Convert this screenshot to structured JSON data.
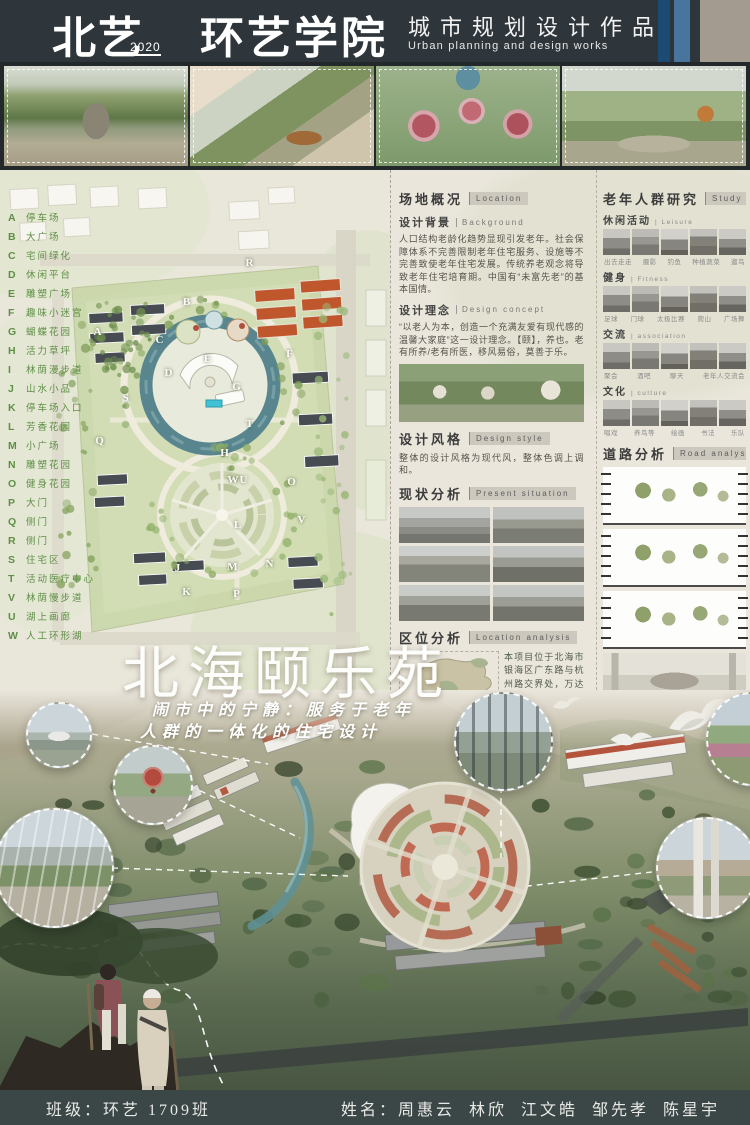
{
  "header": {
    "brand": "北艺",
    "year": "2020",
    "school": "环艺学院",
    "work_title_cn": "城市规划设计作品",
    "work_title_en": "Urban planning and design works"
  },
  "title": {
    "main": "北海颐乐苑",
    "subtitle_line1": "闹市中的宁静：服务于老年",
    "subtitle_line2": "人群的一体化的住宅设计"
  },
  "legend": {
    "items": [
      {
        "letter": "A",
        "label": "停车场"
      },
      {
        "letter": "B",
        "label": "大广场"
      },
      {
        "letter": "C",
        "label": "宅间绿化"
      },
      {
        "letter": "D",
        "label": "休闲平台"
      },
      {
        "letter": "E",
        "label": "雕塑广场"
      },
      {
        "letter": "F",
        "label": "趣味小迷宫"
      },
      {
        "letter": "G",
        "label": "蝴蝶花园"
      },
      {
        "letter": "H",
        "label": "活力草坪"
      },
      {
        "letter": "I",
        "label": "林荫漫步道"
      },
      {
        "letter": "J",
        "label": "山水小品"
      },
      {
        "letter": "K",
        "label": "停车场入口"
      },
      {
        "letter": "L",
        "label": "芳香花园"
      },
      {
        "letter": "M",
        "label": "小广场"
      },
      {
        "letter": "N",
        "label": "雕塑花园"
      },
      {
        "letter": "O",
        "label": "健身花园"
      },
      {
        "letter": "P",
        "label": "大门"
      },
      {
        "letter": "Q",
        "label": "侧门"
      },
      {
        "letter": "R",
        "label": "侧门"
      },
      {
        "letter": "S",
        "label": "住宅区"
      },
      {
        "letter": "T",
        "label": "活动医疗中心"
      },
      {
        "letter": "V",
        "label": "林荫慢步道"
      },
      {
        "letter": "U",
        "label": "湖上画廊"
      },
      {
        "letter": "W",
        "label": "人工环形湖"
      }
    ]
  },
  "plan": {
    "letters": [
      {
        "t": "R",
        "x": 250,
        "y": 93
      },
      {
        "t": "B",
        "x": 187,
        "y": 132
      },
      {
        "t": "A",
        "x": 98,
        "y": 162
      },
      {
        "t": "C",
        "x": 160,
        "y": 170
      },
      {
        "t": "F",
        "x": 290,
        "y": 184
      },
      {
        "t": "E",
        "x": 208,
        "y": 189
      },
      {
        "t": "D",
        "x": 169,
        "y": 203
      },
      {
        "t": "G",
        "x": 237,
        "y": 217
      },
      {
        "t": "S",
        "x": 126,
        "y": 228
      },
      {
        "t": "T",
        "x": 250,
        "y": 254
      },
      {
        "t": "Q",
        "x": 100,
        "y": 271
      },
      {
        "t": "H",
        "x": 225,
        "y": 283
      },
      {
        "t": "WU",
        "x": 238,
        "y": 310
      },
      {
        "t": "O",
        "x": 292,
        "y": 312
      },
      {
        "t": "V",
        "x": 302,
        "y": 350
      },
      {
        "t": "L",
        "x": 238,
        "y": 355
      },
      {
        "t": "N",
        "x": 270,
        "y": 394
      },
      {
        "t": "M",
        "x": 233,
        "y": 397
      },
      {
        "t": "J",
        "x": 178,
        "y": 398
      },
      {
        "t": "K",
        "x": 187,
        "y": 422
      },
      {
        "t": "P",
        "x": 237,
        "y": 424
      }
    ]
  },
  "sections": {
    "site": {
      "cn": "场地概况",
      "en": "Location"
    },
    "background": {
      "cn": "设计背景",
      "en": "Background",
      "text": "人口结构老龄化趋势显现引发老年。社会保障体系不完善限制老年住宅服务、设施等不完善致使老年住宅发展。传统养老观念将导致老年住宅培育期。中国有“未富先老”的基本国情。"
    },
    "concept": {
      "cn": "设计理念",
      "en": "Design concept",
      "text": "“以老人为本，创造一个充满友爱有现代感的温馨大家庭”这一设计理念。【颐】，养也。老有所养/老有所医，移风易俗，莫善于乐。"
    },
    "style": {
      "cn": "设计风格",
      "en": "Design style",
      "text": "整体的设计风格为现代风，整体色调上调和。"
    },
    "present": {
      "cn": "现状分析",
      "en": "Present situation"
    },
    "location": {
      "cn": "区位分析",
      "en": "Location analysis",
      "text": "本项目位于北海市银海区广东路与杭州路交界处，万达广场东侧，南邻杭州路。项目周围由多个商业住宅区，生活方便，有多路公交经过，交通便捷，出行方便。项目用地面积为5.96公顷，中老年为该住宅区的核心人群。"
    }
  },
  "research": {
    "cn": "老年人群研究",
    "en": "Study on the elderly",
    "categories": [
      {
        "cn": "休闲活动",
        "en": "Leisure",
        "captions": [
          "出去走走",
          "摄影",
          "钓鱼",
          "种植蔬菜",
          "遛鸟"
        ]
      },
      {
        "cn": "健身",
        "en": "Fitness",
        "captions": [
          "足球",
          "门球",
          "太极比赛",
          "爬山",
          "广场舞"
        ]
      },
      {
        "cn": "交流",
        "en": "association",
        "captions": [
          "聚会",
          "酒吧",
          "聊天",
          "老年人交流会"
        ]
      },
      {
        "cn": "文化",
        "en": "culture",
        "captions": [
          "唱戏",
          "养鸟等",
          "绘画",
          "书法",
          "乐队"
        ]
      }
    ]
  },
  "road": {
    "cn": "道路分析",
    "en": "Road analysis"
  },
  "footer": {
    "class_label": "班级：环艺 1709班",
    "names_label": "姓名：周惠云  林欣  江文皓  邹先孝  陈星宇"
  },
  "colors": {
    "header_bg": "#2f363b",
    "accent_blue_dark": "#1d4a72",
    "accent_blue": "#48759e",
    "taupe": "#a39a90",
    "paper": "#eae6dc",
    "legend_green": "#5e8f46",
    "lake_teal": "#58858e",
    "roof_orange": "#c0572c",
    "footer_bg": "#3a4746"
  }
}
